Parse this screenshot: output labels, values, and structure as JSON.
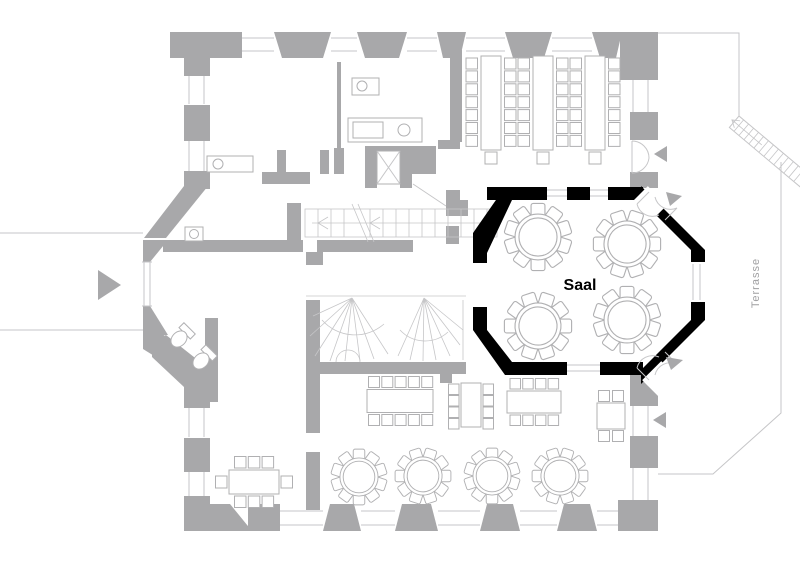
{
  "rooms": [
    {
      "id": "saal",
      "label": "Saal",
      "highlighted": true
    },
    {
      "id": "terrasse",
      "label": "Terrasse",
      "highlighted": false
    }
  ],
  "colors": {
    "background": "#ffffff",
    "wall": "#a8a8aa",
    "wall_line": "#c6c6c8",
    "furniture_line": "#b0b0b2",
    "highlight": "#000000",
    "terrace_label": "#9f9fa1"
  },
  "furniture": {
    "saal_round_tables": 4,
    "seats_per_round_table": 10,
    "seminar_table_rows": 3,
    "restaurant_round_tables": 4
  }
}
